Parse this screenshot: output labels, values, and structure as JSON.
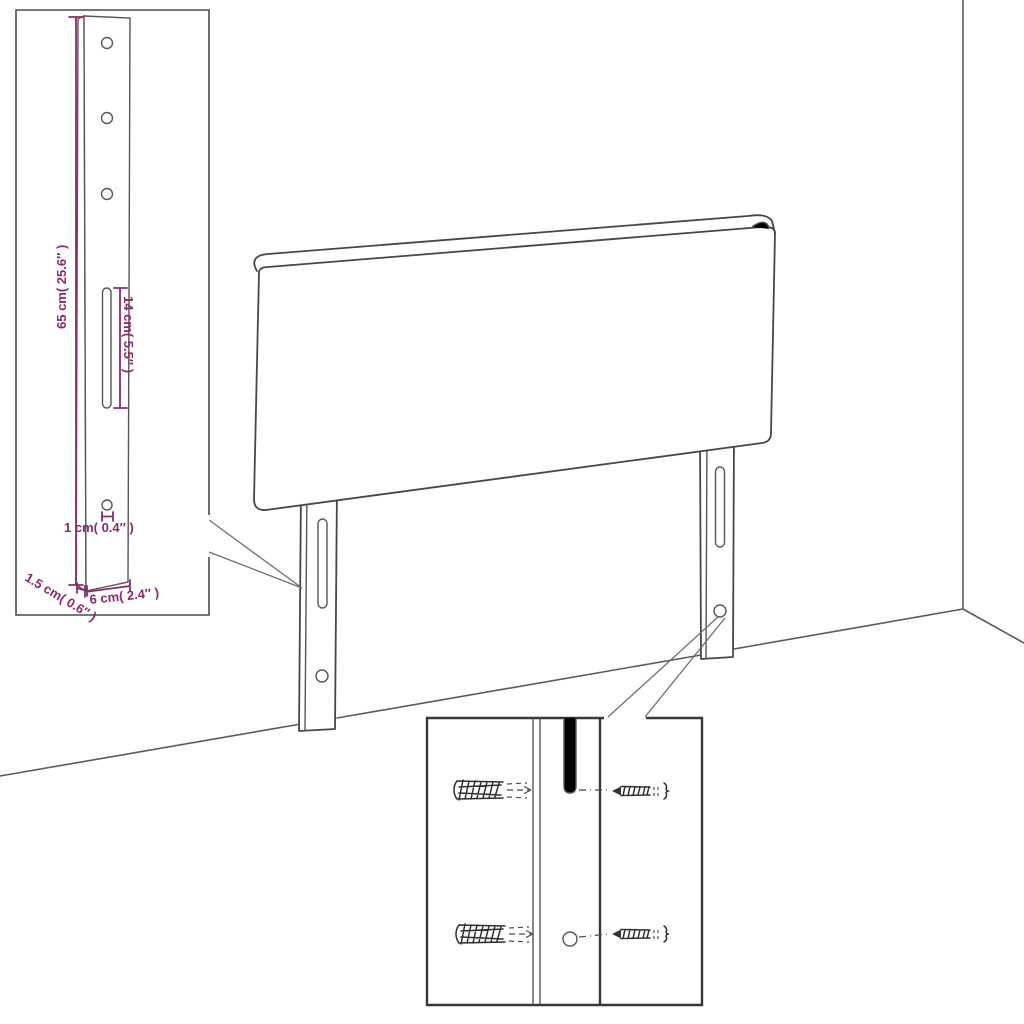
{
  "insets": {
    "leg_detail": {
      "dimensions": {
        "height": "65 cm( 25.6″ )",
        "slot": "14 cm( 5.5″ )",
        "hole": "1 cm( 0.4″ )",
        "thickness": "1.5 cm( 0.6″ )",
        "width": "6 cm( 2.4″ )"
      }
    }
  },
  "colors": {
    "dimension_accent": "#8B2A6B",
    "drawing_line": "#474747"
  }
}
